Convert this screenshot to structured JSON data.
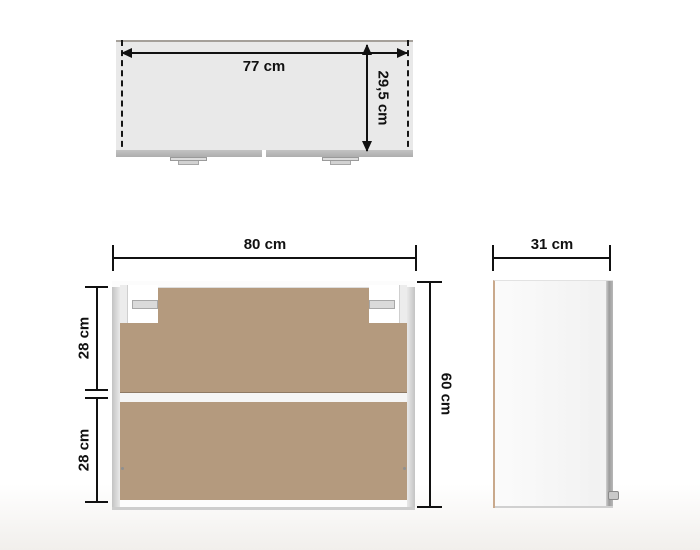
{
  "views": {
    "top_view": {
      "width": "77 cm",
      "depth": "29,5 cm"
    },
    "front_view": {
      "width": "80 cm",
      "height": "60 cm",
      "upper_compartment": "28 cm",
      "lower_compartment": "28 cm"
    },
    "side_view": {
      "depth": "31 cm"
    }
  },
  "colors": {
    "dimension_line": "#111111",
    "top_view_fill": "#e9e9e9",
    "door_edge_gray": "#b5b5b5",
    "interior_hardboard": "#b49a7e",
    "frame_gray": "#d6d6d6",
    "side_panel_edge_tan": "#c9a98c"
  }
}
